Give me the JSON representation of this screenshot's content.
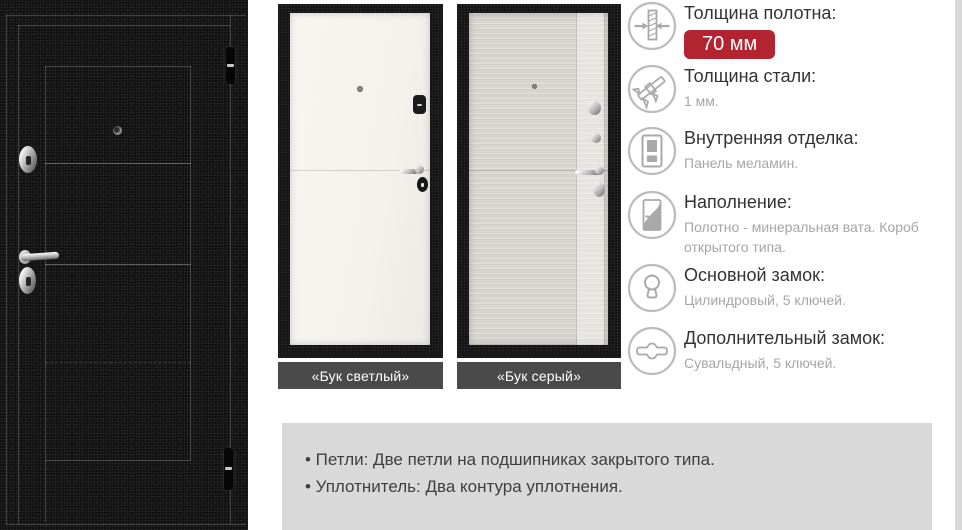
{
  "variants": [
    {
      "label": "«Бук светлый»"
    },
    {
      "label": "«Бук серый»"
    }
  ],
  "specs": [
    {
      "icon": "panel-thickness-icon",
      "title": "Толщина полотна:",
      "value": "70 мм"
    },
    {
      "icon": "caliper-icon",
      "title": "Толщина стали:",
      "value": "1 мм."
    },
    {
      "icon": "interior-finish-icon",
      "title": "Внутренняя отделка:",
      "value": "Панель меламин."
    },
    {
      "icon": "door-filling-icon",
      "title": "Наполнение:",
      "value": "Полотно - минеральная вата. Короб открытого типа."
    },
    {
      "icon": "main-lock-icon",
      "title": "Основной замок:",
      "value": "Цилиндровый, 5 ключей."
    },
    {
      "icon": "extra-lock-icon",
      "title": "Дополнительный замок:",
      "value": "Сувальдный, 5 ключей."
    }
  ],
  "notes": {
    "items": [
      "• Петли: Две петли на подшипниках закрытого типа.",
      "• Уплотнитель: Два контура уплотнения."
    ]
  },
  "colors": {
    "accent_red": "#b2242f",
    "variant_label_bar": "#4a4a4a",
    "notes_background": "#d9d9d9"
  }
}
